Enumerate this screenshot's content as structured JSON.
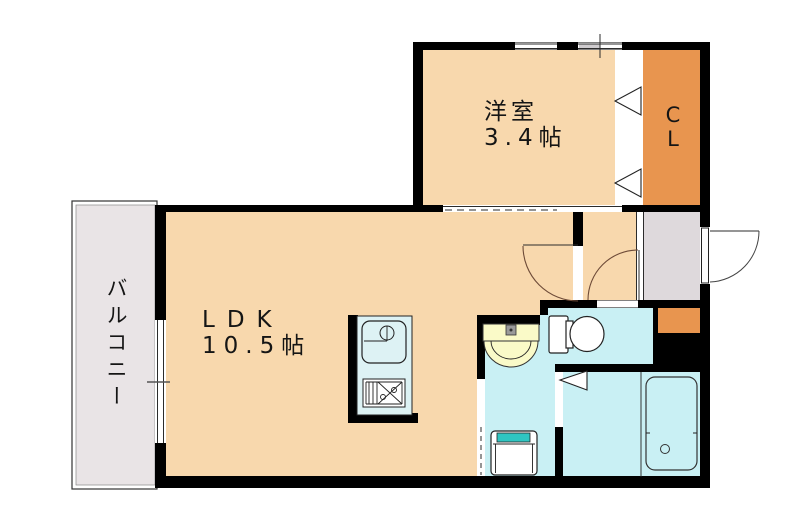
{
  "document_type": "apartment-floor-plan",
  "rooms": {
    "western_room": {
      "name": "洋室",
      "size": "3.4帖"
    },
    "ldk": {
      "name": "LDK",
      "size": "10.5帖"
    },
    "closet": {
      "label": "C\nL"
    },
    "balcony": {
      "name": "バルコニー"
    }
  },
  "fixtures": {
    "kitchen": [
      "kitchen-sink-icon",
      "gas-stove-icon"
    ],
    "washroom": [
      "wash-basin-icon",
      "washing-machine-pan-icon"
    ],
    "toilet_room": [
      "toilet-icon"
    ],
    "bathroom": [
      "bathtub-icon"
    ],
    "doors": [
      "ldk-door-arc",
      "toilet-door-arc",
      "entrance-door-arc",
      "closet-folding-door",
      "bathroom-door"
    ]
  },
  "colors": {
    "wall": "#000000",
    "room-peach": "#f8d8ad",
    "closet-orange": "#e8954f",
    "balcony-gray": "#e9e4e6",
    "entrance-gray": "#ded9dc",
    "water-cyan": "#c9f0f4",
    "kitchen-cyan": "#ddf2f4",
    "basin-yellow": "#fafac8",
    "washer-teal": "#2fc5c1"
  }
}
